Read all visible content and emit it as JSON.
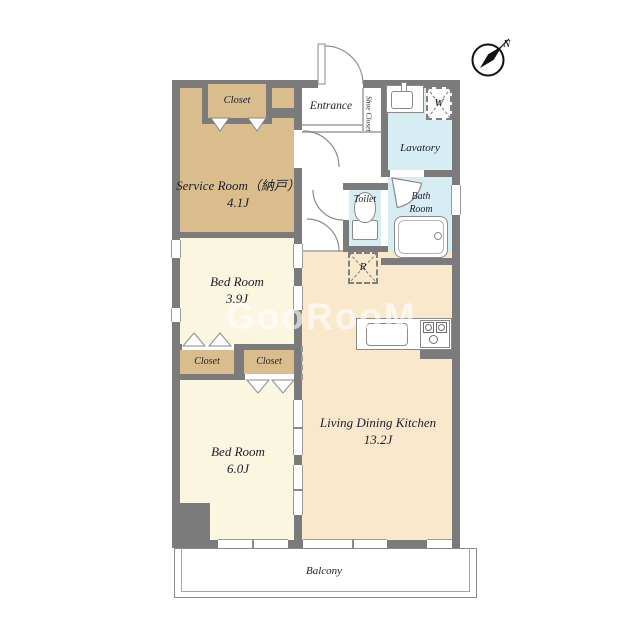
{
  "compass": {
    "north": "N"
  },
  "watermark": "GooRooM",
  "rooms": {
    "closet_top": {
      "label": "Closet"
    },
    "service_room": {
      "label": "Service Room（納戸）",
      "size": "4.1J"
    },
    "entrance": {
      "label": "Entrance"
    },
    "shoe_closet": {
      "label": "Shoe Closet"
    },
    "lavatory": {
      "label": "Lavatory"
    },
    "washing_machine": {
      "label": "W"
    },
    "toilet": {
      "label": "Toilet"
    },
    "bath_room": {
      "label": "Bath Room"
    },
    "bed_room_1": {
      "label": "Bed Room",
      "size": "3.9J"
    },
    "closet_mid_left": {
      "label": "Closet"
    },
    "closet_mid_right": {
      "label": "Closet"
    },
    "bed_room_2": {
      "label": "Bed Room",
      "size": "6.0J"
    },
    "ldk": {
      "label": "Living Dining Kitchen",
      "size": "13.2J"
    },
    "refrigerator": {
      "label": "R"
    },
    "balcony": {
      "label": "Balcony"
    }
  },
  "colors": {
    "wall": "#7b7b7b",
    "closet_tan": "#d9bd8d",
    "bedroom_cream": "#faf6df",
    "ldk_peach": "#fae8cc",
    "wet_area_blue": "#d6edf3",
    "label_ink": "#1d1d28"
  }
}
